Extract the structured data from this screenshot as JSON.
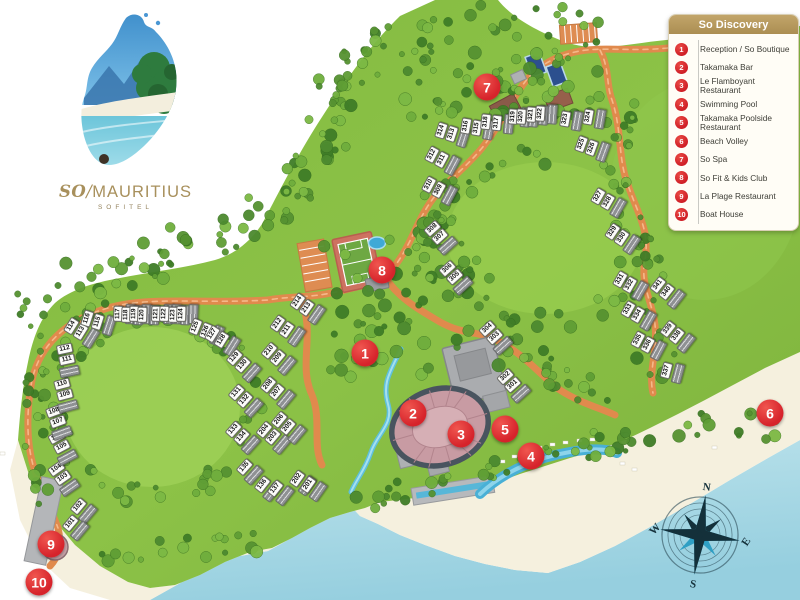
{
  "legend": {
    "title": "So Discovery",
    "items": [
      {
        "num": "1",
        "label": "Reception / So Boutique"
      },
      {
        "num": "2",
        "label": "Takamaka Bar"
      },
      {
        "num": "3",
        "label": "Le Flamboyant Restaurant"
      },
      {
        "num": "4",
        "label": "Swimming Pool"
      },
      {
        "num": "5",
        "label": "Takamaka Poolside Restaurant"
      },
      {
        "num": "6",
        "label": "Beach Volley"
      },
      {
        "num": "7",
        "label": "So Spa"
      },
      {
        "num": "8",
        "label": "So Fit & Kids Club"
      },
      {
        "num": "9",
        "label": "La Plage Restaurant"
      },
      {
        "num": "10",
        "label": "Boat House"
      }
    ]
  },
  "logo": {
    "so": "SO",
    "slash": "/",
    "name": "MAURITIUS",
    "sub": "SOFITEL"
  },
  "compass": {
    "n": "N",
    "e": "E",
    "s": "S",
    "w": "W"
  },
  "colors": {
    "accent_red": "#d6232b",
    "legend_gold": "#b3975d",
    "road": "#e08a4d",
    "land": "#86bd43",
    "sea": "#aadbe7",
    "sand": "#f5f0de"
  },
  "map": {
    "markers": [
      {
        "num": "1",
        "x": 365,
        "y": 353
      },
      {
        "num": "2",
        "x": 413,
        "y": 413
      },
      {
        "num": "3",
        "x": 461,
        "y": 434
      },
      {
        "num": "4",
        "x": 531,
        "y": 456
      },
      {
        "num": "5",
        "x": 505,
        "y": 429
      },
      {
        "num": "6",
        "x": 770,
        "y": 413
      },
      {
        "num": "7",
        "x": 487,
        "y": 87
      },
      {
        "num": "8",
        "x": 382,
        "y": 270
      },
      {
        "num": "9",
        "x": 51,
        "y": 544
      },
      {
        "num": "10",
        "x": 39,
        "y": 582
      }
    ],
    "villas": [
      {
        "n": [
          "102"
        ],
        "x": 83,
        "y": 510,
        "r": -50
      },
      {
        "n": [
          "101"
        ],
        "x": 75,
        "y": 527,
        "r": -50
      },
      {
        "n": [
          "104",
          "103"
        ],
        "x": 63,
        "y": 478,
        "r": -35
      },
      {
        "n": [
          "106",
          "105"
        ],
        "x": 62,
        "y": 447,
        "r": -28
      },
      {
        "n": [
          "108",
          "107"
        ],
        "x": 58,
        "y": 422,
        "r": -20
      },
      {
        "n": [
          "110",
          "109"
        ],
        "x": 65,
        "y": 395,
        "r": -15
      },
      {
        "n": [
          "112",
          "111"
        ],
        "x": 67,
        "y": 360,
        "r": -12
      },
      {
        "n": [
          "114",
          "113"
        ],
        "x": 81,
        "y": 332,
        "r": -58
      },
      {
        "n": [
          "116",
          "115"
        ],
        "x": 98,
        "y": 322,
        "r": -72
      },
      {
        "n": [
          "117"
        ],
        "x": 124,
        "y": 314,
        "r": -88
      },
      {
        "n": [
          "118"
        ],
        "x": 132,
        "y": 315,
        "r": -88
      },
      {
        "n": [
          "119"
        ],
        "x": 140,
        "y": 314,
        "r": -88
      },
      {
        "n": [
          "120"
        ],
        "x": 148,
        "y": 315,
        "r": -88
      },
      {
        "n": [
          "121"
        ],
        "x": 162,
        "y": 314,
        "r": -88
      },
      {
        "n": [
          "122"
        ],
        "x": 170,
        "y": 314,
        "r": -88
      },
      {
        "n": [
          "123"
        ],
        "x": 179,
        "y": 315,
        "r": -88
      },
      {
        "n": [
          "124"
        ],
        "x": 187,
        "y": 314,
        "r": -88
      },
      {
        "n": [
          "125",
          "126"
        ],
        "x": 206,
        "y": 331,
        "r": -68
      },
      {
        "n": [
          "127",
          "128"
        ],
        "x": 222,
        "y": 340,
        "r": -58
      },
      {
        "n": [
          "129",
          "130"
        ],
        "x": 243,
        "y": 365,
        "r": -48
      },
      {
        "n": [
          "131",
          "132"
        ],
        "x": 245,
        "y": 400,
        "r": -48
      },
      {
        "n": [
          "133",
          "134"
        ],
        "x": 242,
        "y": 437,
        "r": -48
      },
      {
        "n": [
          "135"
        ],
        "x": 249,
        "y": 471,
        "r": -48
      },
      {
        "n": [
          "136"
        ],
        "x": 267,
        "y": 488,
        "r": -52
      },
      {
        "n": [
          "137"
        ],
        "x": 280,
        "y": 492,
        "r": -52
      },
      {
        "n": [
          "202"
        ],
        "x": 302,
        "y": 482,
        "r": -55
      },
      {
        "n": [
          "201"
        ],
        "x": 313,
        "y": 488,
        "r": -55
      },
      {
        "n": [
          "204",
          "203"
        ],
        "x": 273,
        "y": 437,
        "r": -50
      },
      {
        "n": [
          "206",
          "205"
        ],
        "x": 288,
        "y": 427,
        "r": -50
      },
      {
        "n": [
          "208",
          "207"
        ],
        "x": 277,
        "y": 392,
        "r": -50
      },
      {
        "n": [
          "210",
          "209"
        ],
        "x": 278,
        "y": 358,
        "r": -50
      },
      {
        "n": [
          "212",
          "211"
        ],
        "x": 287,
        "y": 330,
        "r": -55
      },
      {
        "n": [
          "214",
          "213"
        ],
        "x": 307,
        "y": 308,
        "r": -55
      },
      {
        "n": [
          "302",
          "301"
        ],
        "x": 513,
        "y": 385,
        "r": -42
      },
      {
        "n": [
          "304",
          "303"
        ],
        "x": 495,
        "y": 337,
        "r": -42
      },
      {
        "n": [
          "306",
          "305"
        ],
        "x": 455,
        "y": 277,
        "r": -42
      },
      {
        "n": [
          "308",
          "307"
        ],
        "x": 440,
        "y": 237,
        "r": -42
      },
      {
        "n": [
          "310",
          "309"
        ],
        "x": 439,
        "y": 190,
        "r": -62
      },
      {
        "n": [
          "312",
          "311"
        ],
        "x": 442,
        "y": 160,
        "r": -62
      },
      {
        "n": [
          "314",
          "313"
        ],
        "x": 452,
        "y": 134,
        "r": -72
      },
      {
        "n": [
          "316",
          "315"
        ],
        "x": 477,
        "y": 128,
        "r": -80
      },
      {
        "n": [
          "318",
          "317"
        ],
        "x": 497,
        "y": 123,
        "r": -84
      },
      {
        "n": [
          "319"
        ],
        "x": 519,
        "y": 117,
        "r": -86
      },
      {
        "n": [
          "320"
        ],
        "x": 527,
        "y": 117,
        "r": -86
      },
      {
        "n": [
          "321"
        ],
        "x": 537,
        "y": 115,
        "r": -86
      },
      {
        "n": [
          "322"
        ],
        "x": 546,
        "y": 114,
        "r": -86
      },
      {
        "n": [
          "323"
        ],
        "x": 571,
        "y": 120,
        "r": -80
      },
      {
        "n": [
          "324"
        ],
        "x": 594,
        "y": 118,
        "r": -80
      },
      {
        "n": [
          "325",
          "326"
        ],
        "x": 592,
        "y": 148,
        "r": -70
      },
      {
        "n": [
          "327",
          "328"
        ],
        "x": 608,
        "y": 202,
        "r": -60
      },
      {
        "n": [
          "329",
          "330"
        ],
        "x": 622,
        "y": 238,
        "r": -56
      },
      {
        "n": [
          "331",
          "332"
        ],
        "x": 630,
        "y": 285,
        "r": -60
      },
      {
        "n": [
          "333",
          "334"
        ],
        "x": 638,
        "y": 315,
        "r": -60
      },
      {
        "n": [
          "335",
          "336"
        ],
        "x": 648,
        "y": 345,
        "r": -62
      },
      {
        "n": [
          "341",
          "340"
        ],
        "x": 667,
        "y": 292,
        "r": -52
      },
      {
        "n": [
          "339",
          "338"
        ],
        "x": 677,
        "y": 336,
        "r": -52
      },
      {
        "n": [
          "337"
        ],
        "x": 672,
        "y": 372,
        "r": -75
      }
    ]
  }
}
